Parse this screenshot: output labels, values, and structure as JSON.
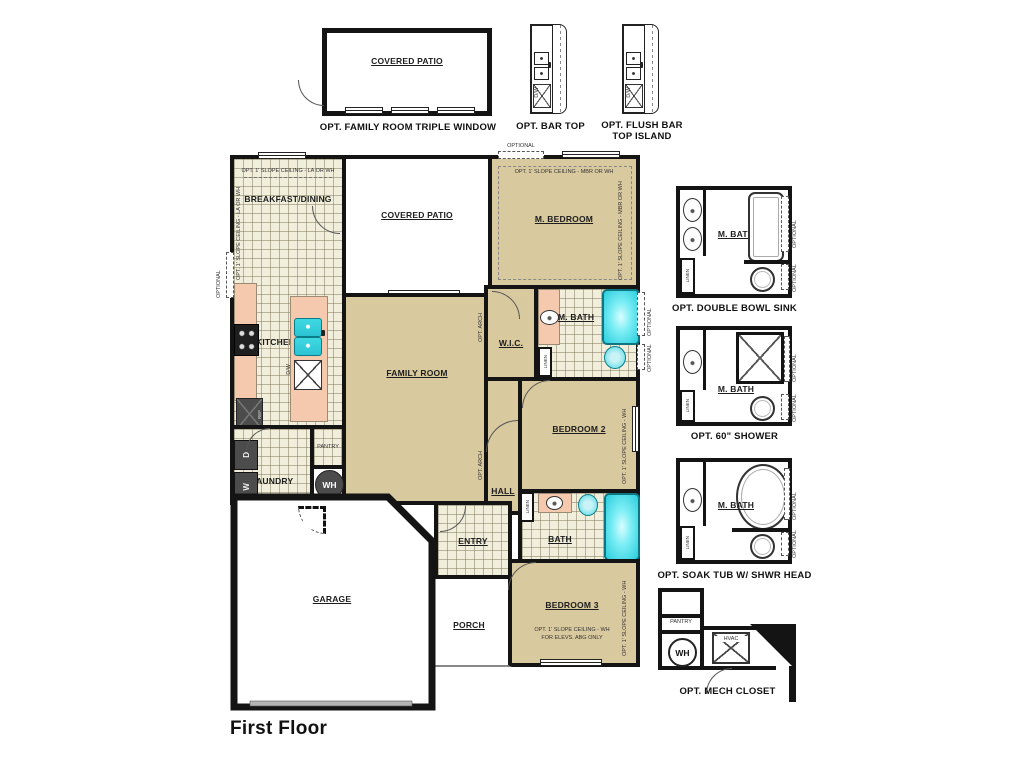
{
  "title": "First Floor",
  "colors": {
    "wall": "#141414",
    "room_tan": "#d9c99f",
    "tile_floor": "#f1eedb",
    "counter_salmon": "#f4c9ae",
    "fixture_cyan": "#35d9e4",
    "appliance_gray": "#4c4c4c"
  },
  "common": {
    "covered_patio": "COVERED PATIO",
    "m_bath": "M. BATH",
    "optional": "OPTIONAL",
    "linen": "LINEN",
    "pantry": "PANTRY",
    "wh": "WH",
    "washer": "W",
    "dryer": "D",
    "dw": "D/W",
    "ref": "REF",
    "hvac": "HVAC"
  },
  "top_details": {
    "triple_window_caption": "OPT. FAMILY ROOM TRIPLE WINDOW",
    "bar_top_caption": "OPT. BAR TOP",
    "flush_bar_caption_line1": "OPT. FLUSH BAR",
    "flush_bar_caption_line2": "TOP ISLAND"
  },
  "rooms": {
    "breakfast_dining": "BREAKFAST/DINING",
    "kitchen": "KITCHEN",
    "family_room": "FAMILY ROOM",
    "m_bedroom": "M. BEDROOM",
    "wic": "W.I.C.",
    "bedroom2": "BEDROOM 2",
    "hall": "HALL",
    "bath": "BATH",
    "bedroom3": "BEDROOM 3",
    "laundry": "LAUNDRY",
    "entry": "ENTRY",
    "porch": "PORCH",
    "garage": "GARAGE"
  },
  "annotations": {
    "slope_la": "OPT. 1' SLOPE CEILING - LA OR WH",
    "slope_mbr": "OPT. 1' SLOPE CEILING - MBR OR WH",
    "slope_wh": "OPT. 1' SLOPE CEILING - WH",
    "for_elevs": "FOR ELEVS. ABG ONLY",
    "opt_arch": "OPT. ARCH"
  },
  "right_details": [
    {
      "caption": "OPT. DOUBLE BOWL SINK"
    },
    {
      "caption": "OPT. 60\" SHOWER"
    },
    {
      "caption": "OPT. SOAK TUB W/ SHWR HEAD"
    },
    {
      "caption": "OPT. MECH CLOSET"
    }
  ]
}
